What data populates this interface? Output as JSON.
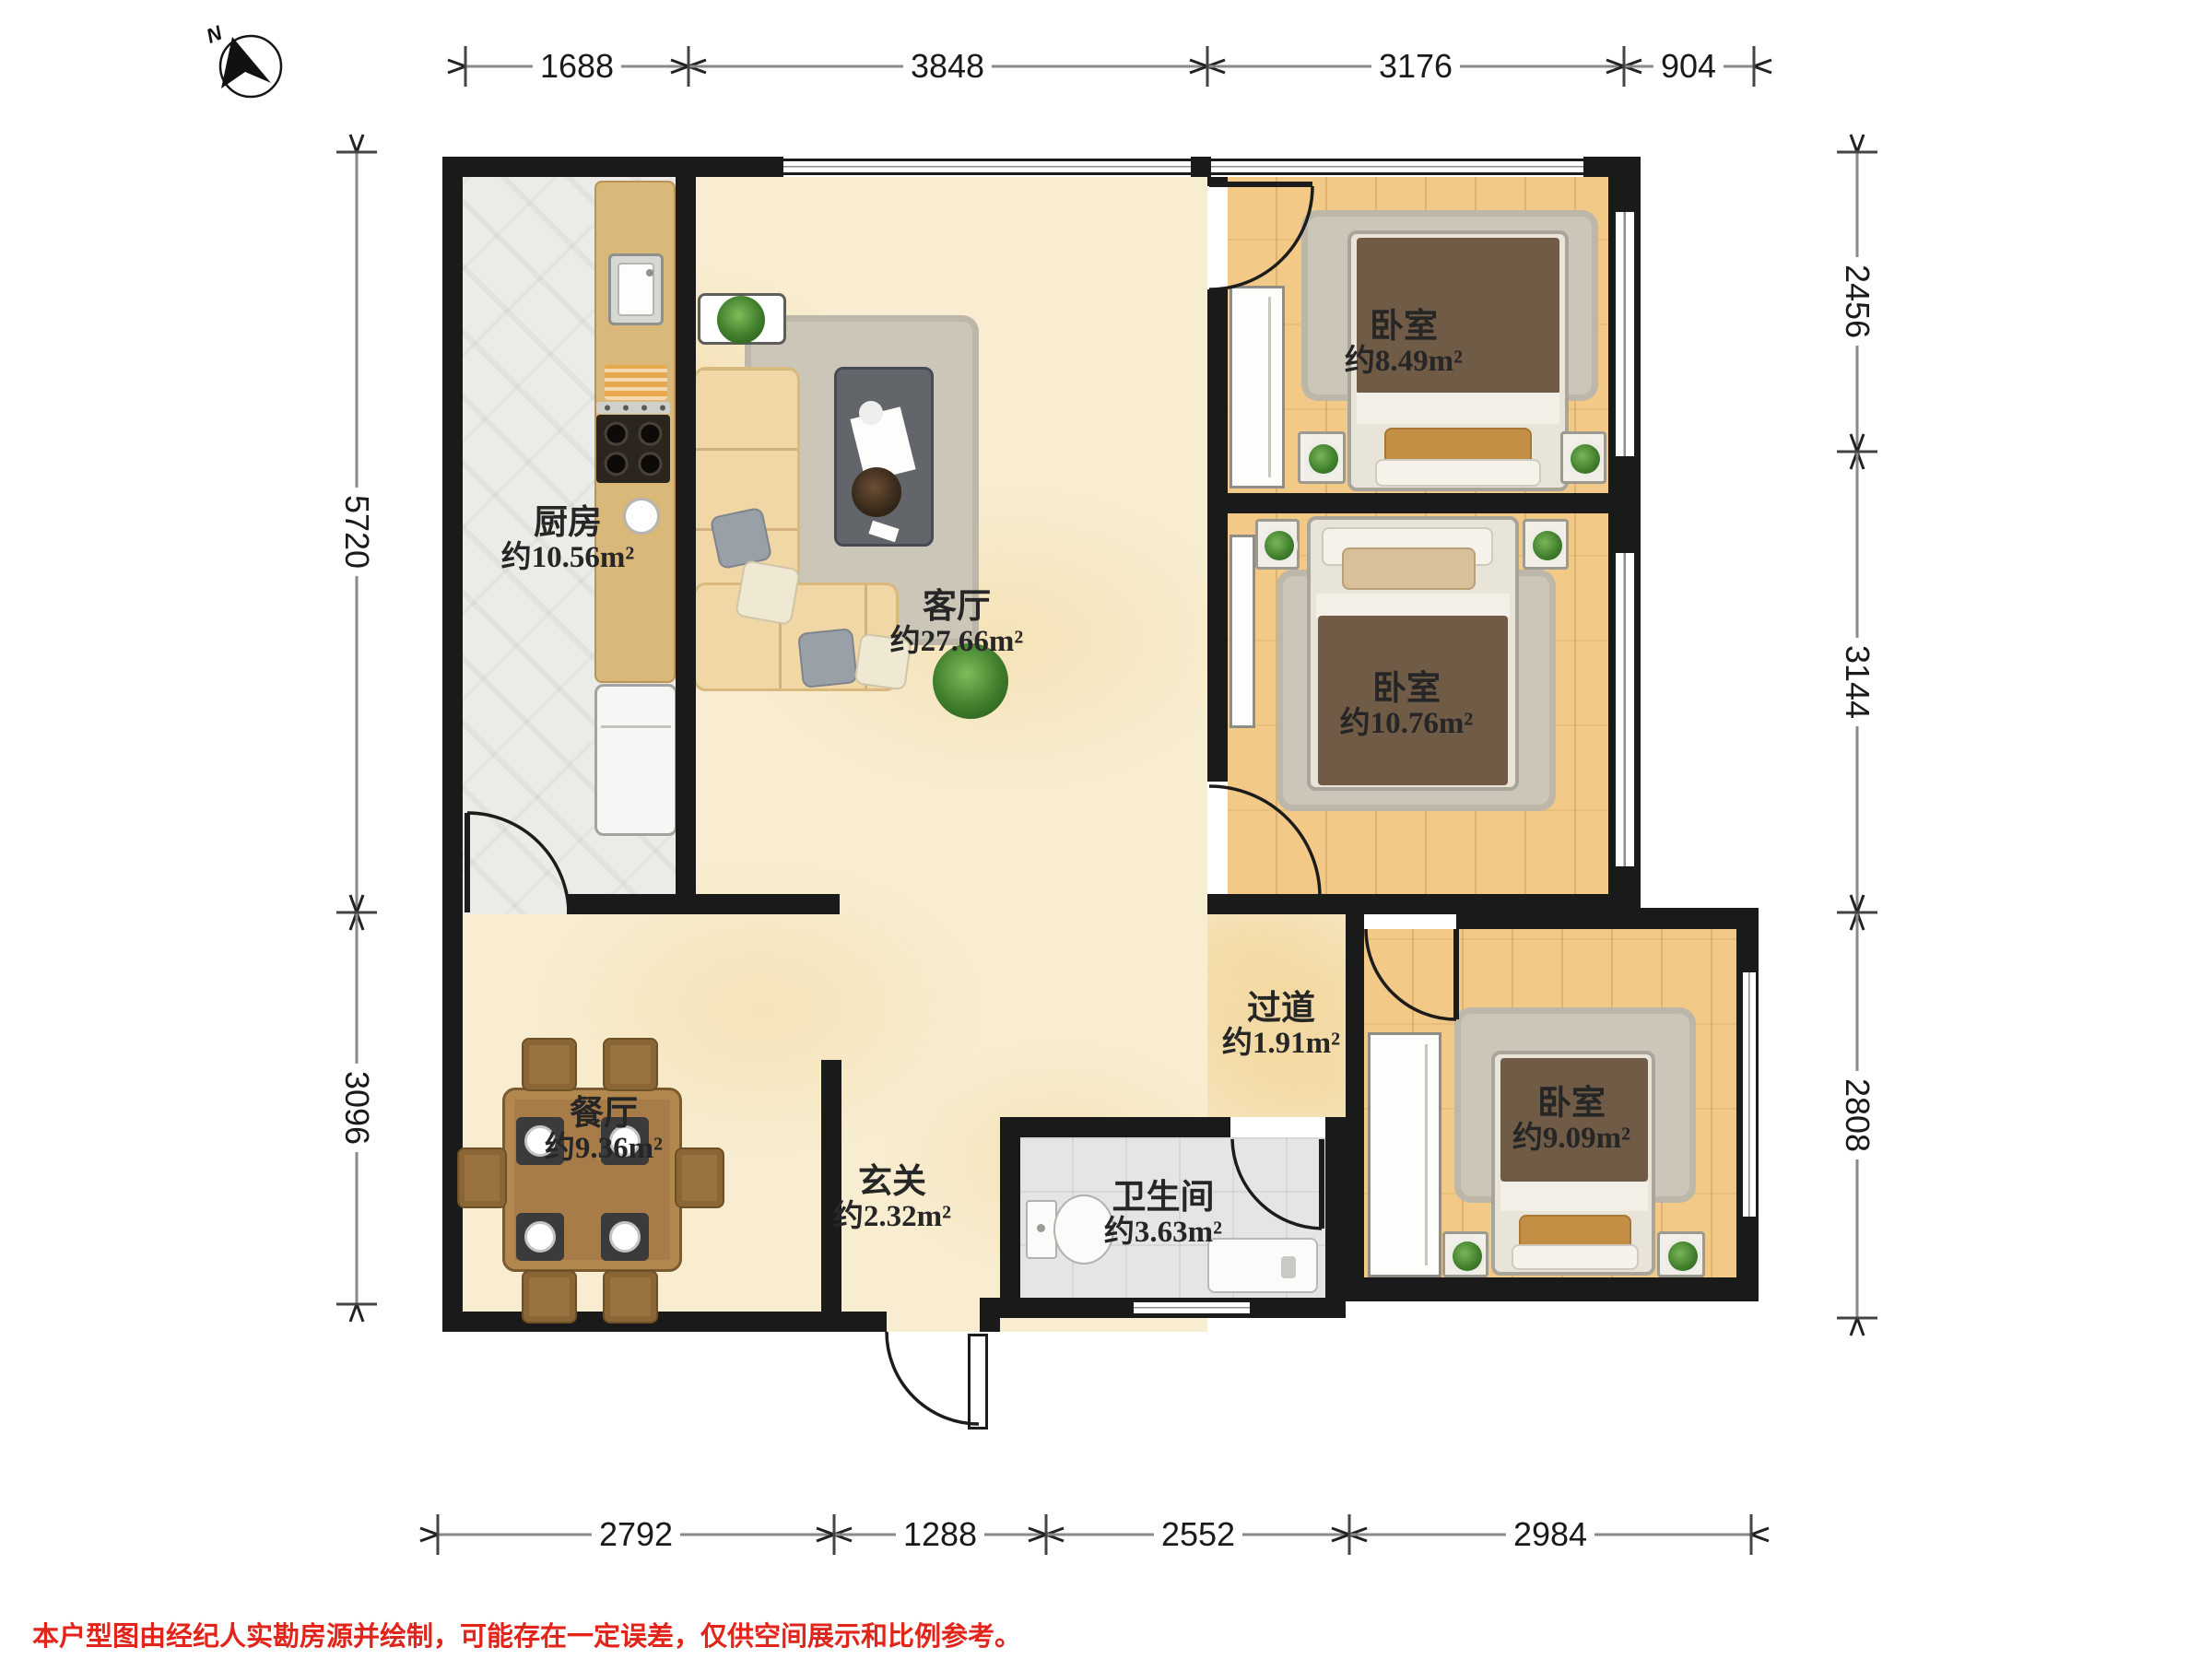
{
  "compass": {
    "north_label": "N"
  },
  "rooms": {
    "kitchen": {
      "name": "厨房",
      "area": "约10.56m²"
    },
    "living": {
      "name": "客厅",
      "area": "约27.66m²"
    },
    "bedroom_top": {
      "name": "卧室",
      "area": "约8.49m²"
    },
    "bedroom_mid": {
      "name": "卧室",
      "area": "约10.76m²"
    },
    "bedroom_bottom": {
      "name": "卧室",
      "area": "约9.09m²"
    },
    "hallway": {
      "name": "过道",
      "area": "约1.91m²"
    },
    "dining": {
      "name": "餐厅",
      "area": "约9.36m²"
    },
    "entry": {
      "name": "玄关",
      "area": "约2.32m²"
    },
    "bathroom": {
      "name": "卫生间",
      "area": "约3.63m²"
    }
  },
  "dimensions": {
    "top": [
      "1688",
      "3848",
      "3176",
      "904"
    ],
    "bottom": [
      "2792",
      "1288",
      "2552",
      "2984"
    ],
    "left": [
      "5720",
      "3096"
    ],
    "right": [
      "2456",
      "3144",
      "2808"
    ]
  },
  "disclaimer": "本户型图由经纪人实勘房源并绘制，可能存在一定误差，仅供空间展示和比例参考。",
  "colors": {
    "wall": "#1a1a1a",
    "wood": "#f2c987",
    "cream": "#f8edd0",
    "ktile": "#ebebe7",
    "btile": "#e4e5e7",
    "counter": "#d9b87a",
    "rug": "#cbc6b8",
    "blanket": "#6f5b46",
    "pillow": "#c28f45",
    "table": "#a87c48",
    "sofa": "#f1d7a6",
    "plant": "#4c8a38",
    "dimc": "#1a1a1a",
    "disc": "#e1251b"
  }
}
